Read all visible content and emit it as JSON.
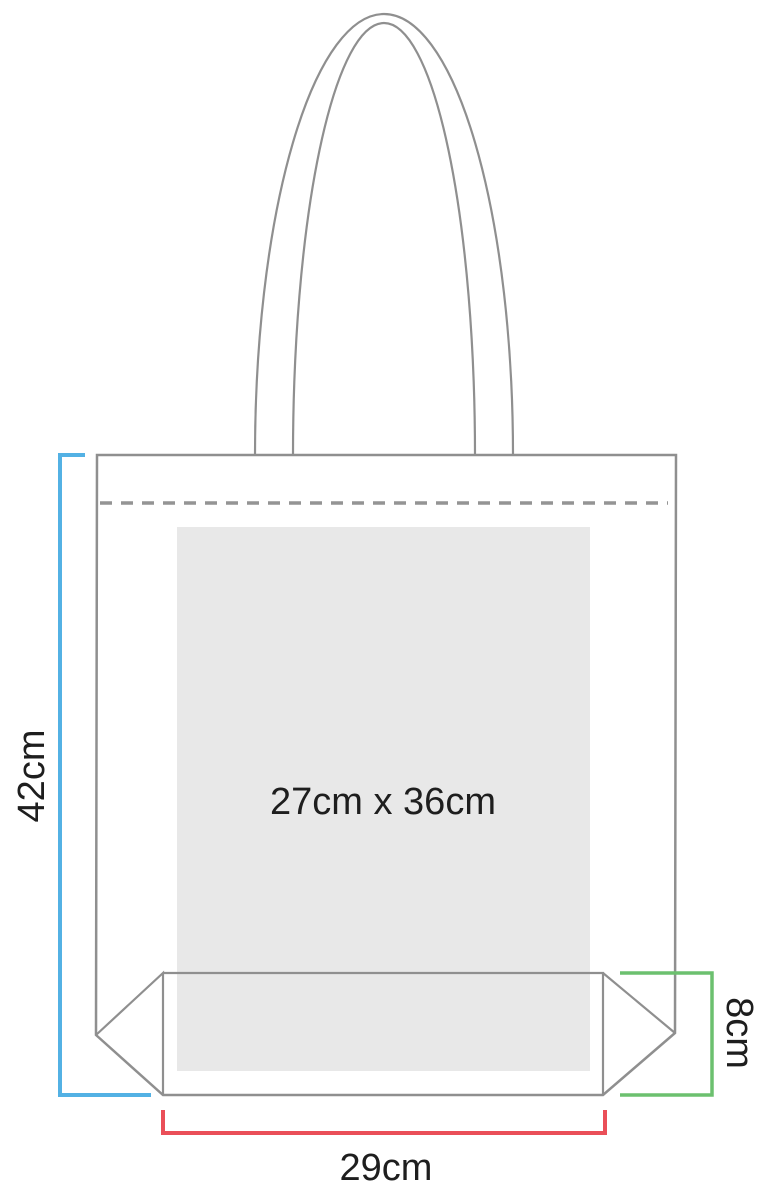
{
  "diagram": {
    "subject": "tote bag dimension diagram",
    "labels": {
      "bag_height": "42cm",
      "bag_width": "29cm",
      "gusset_depth": "8cm",
      "print_area": "27cm x 36cm"
    },
    "colors": {
      "bag_outline": "#8f8f8f",
      "fold_line": "#949494",
      "print_area_fill": "#e8e8e8",
      "height_line": "#53b1e4",
      "width_line": "#ea4f58",
      "gusset_line": "#6cc06f",
      "label_text": "#1e1e1e"
    }
  }
}
